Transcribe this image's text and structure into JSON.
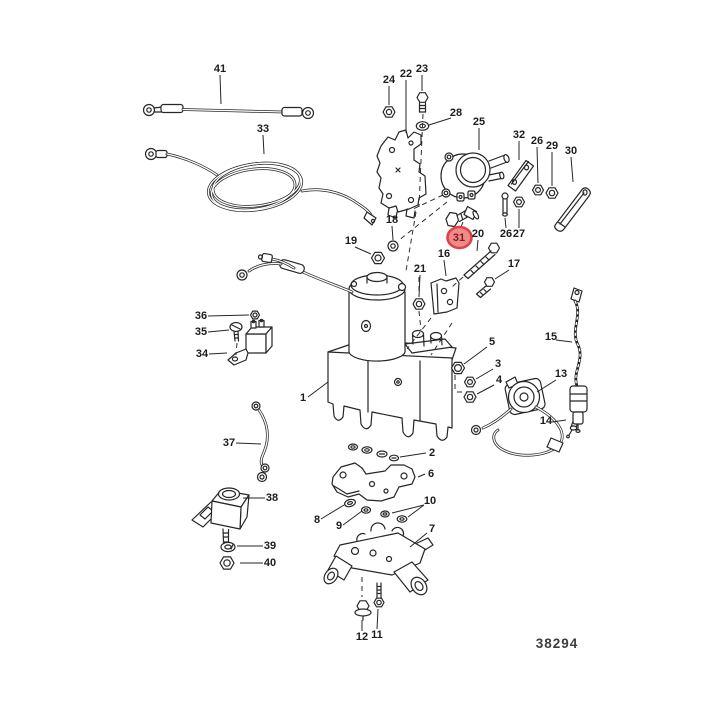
{
  "diagram": {
    "drawing_number": "38294",
    "background_color": "#ffffff",
    "line_color": "#262626",
    "highlight": {
      "part": "31",
      "fill": "#f28a8a",
      "stroke": "#dd4343",
      "text_color": "#7c1d1d"
    },
    "labels": [
      {
        "id": "41",
        "text": "41",
        "x": 220,
        "y": 72
      },
      {
        "id": "33",
        "text": "33",
        "x": 263,
        "y": 132
      },
      {
        "id": "24",
        "text": "24",
        "x": 389,
        "y": 83
      },
      {
        "id": "22",
        "text": "22",
        "x": 406,
        "y": 77
      },
      {
        "id": "23",
        "text": "23",
        "x": 422,
        "y": 72
      },
      {
        "id": "28",
        "text": "28",
        "x": 456,
        "y": 116
      },
      {
        "id": "25",
        "text": "25",
        "x": 479,
        "y": 125
      },
      {
        "id": "32",
        "text": "32",
        "x": 519,
        "y": 138
      },
      {
        "id": "26a",
        "text": "26",
        "x": 537,
        "y": 144
      },
      {
        "id": "29",
        "text": "29",
        "x": 552,
        "y": 149
      },
      {
        "id": "30",
        "text": "30",
        "x": 571,
        "y": 154
      },
      {
        "id": "18",
        "text": "18",
        "x": 392,
        "y": 223
      },
      {
        "id": "19",
        "text": "19",
        "x": 351,
        "y": 244
      },
      {
        "id": "31",
        "text": "31",
        "x": 459,
        "y": 241,
        "highlighted": true
      },
      {
        "id": "20",
        "text": "20",
        "x": 478,
        "y": 237
      },
      {
        "id": "26b",
        "text": "26",
        "x": 506,
        "y": 237
      },
      {
        "id": "27",
        "text": "27",
        "x": 519,
        "y": 237
      },
      {
        "id": "16",
        "text": "16",
        "x": 444,
        "y": 257
      },
      {
        "id": "21",
        "text": "21",
        "x": 420,
        "y": 272
      },
      {
        "id": "17",
        "text": "17",
        "x": 514,
        "y": 267
      },
      {
        "id": "15",
        "text": "15",
        "x": 551,
        "y": 340
      },
      {
        "id": "13",
        "text": "13",
        "x": 561,
        "y": 377
      },
      {
        "id": "14",
        "text": "14",
        "x": 546,
        "y": 424
      },
      {
        "id": "5",
        "text": "5",
        "x": 492,
        "y": 345
      },
      {
        "id": "3",
        "text": "3",
        "x": 498,
        "y": 367
      },
      {
        "id": "4",
        "text": "4",
        "x": 499,
        "y": 383
      },
      {
        "id": "1",
        "text": "1",
        "x": 303,
        "y": 401
      },
      {
        "id": "36",
        "text": "36",
        "x": 201,
        "y": 319
      },
      {
        "id": "35",
        "text": "35",
        "x": 201,
        "y": 335
      },
      {
        "id": "34",
        "text": "34",
        "x": 202,
        "y": 357
      },
      {
        "id": "37",
        "text": "37",
        "x": 229,
        "y": 446
      },
      {
        "id": "38",
        "text": "38",
        "x": 272,
        "y": 501
      },
      {
        "id": "39",
        "text": "39",
        "x": 270,
        "y": 549
      },
      {
        "id": "40",
        "text": "40",
        "x": 270,
        "y": 566
      },
      {
        "id": "2",
        "text": "2",
        "x": 432,
        "y": 456
      },
      {
        "id": "6",
        "text": "6",
        "x": 431,
        "y": 477
      },
      {
        "id": "10",
        "text": "10",
        "x": 430,
        "y": 504
      },
      {
        "id": "7",
        "text": "7",
        "x": 432,
        "y": 532
      },
      {
        "id": "8",
        "text": "8",
        "x": 317,
        "y": 523
      },
      {
        "id": "9",
        "text": "9",
        "x": 339,
        "y": 529
      },
      {
        "id": "11",
        "text": "11",
        "x": 377,
        "y": 638
      },
      {
        "id": "12",
        "text": "12",
        "x": 362,
        "y": 640
      }
    ]
  }
}
